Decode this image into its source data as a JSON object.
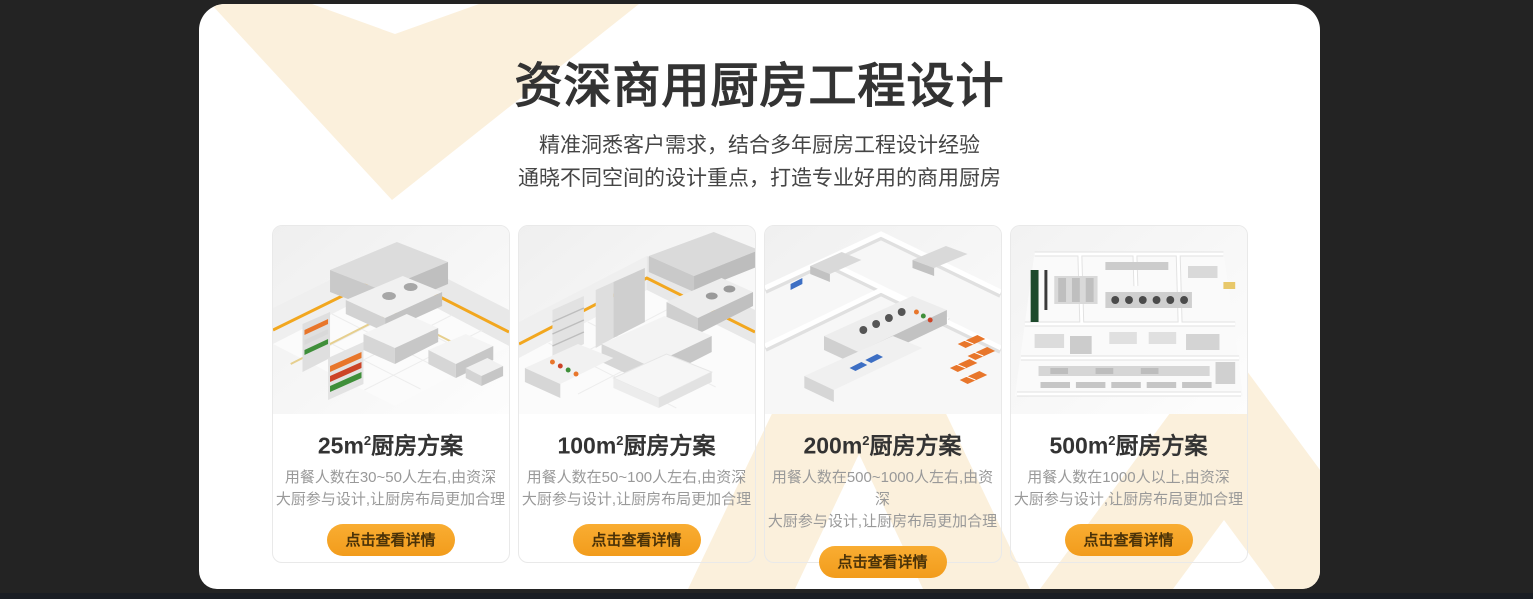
{
  "theme": {
    "page_background": "#232323",
    "bottom_bar": "#1A1D23",
    "panel_background": "#FFFFFF",
    "accent_orange": "#F5A226",
    "decor_cream": "#FBF0DC",
    "title_color": "#333333",
    "subtitle_color": "#454545",
    "description_color": "#999999",
    "button_text_color": "#4A3208"
  },
  "header": {
    "title": "资深商用厨房工程设计",
    "subtitle_line1": "精准洞悉客户需求，结合多年厨房工程设计经验",
    "subtitle_line2": "通晓不同空间的设计重点，打造专业好用的商用厨房"
  },
  "cards": [
    {
      "area": "25m",
      "area_sup": "2",
      "title_suffix": "厨房方案",
      "desc_line1": "用餐人数在30~50人左右,由资深",
      "desc_line2": "大厨参与设计,让厨房布局更加合理",
      "button_label": "点击查看详情"
    },
    {
      "area": "100m",
      "area_sup": "2",
      "title_suffix": "厨房方案",
      "desc_line1": "用餐人数在50~100人左右,由资深",
      "desc_line2": "大厨参与设计,让厨房布局更加合理",
      "button_label": "点击查看详情"
    },
    {
      "area": "200m",
      "area_sup": "2",
      "title_suffix": "厨房方案",
      "desc_line1": "用餐人数在500~1000人左右,由资深",
      "desc_line2": "大厨参与设计,让厨房布局更加合理",
      "button_label": "点击查看详情"
    },
    {
      "area": "500m",
      "area_sup": "2",
      "title_suffix": "厨房方案",
      "desc_line1": "用餐人数在1000人以上,由资深",
      "desc_line2": "大厨参与设计,让厨房布局更加合理",
      "button_label": "点击查看详情"
    }
  ]
}
